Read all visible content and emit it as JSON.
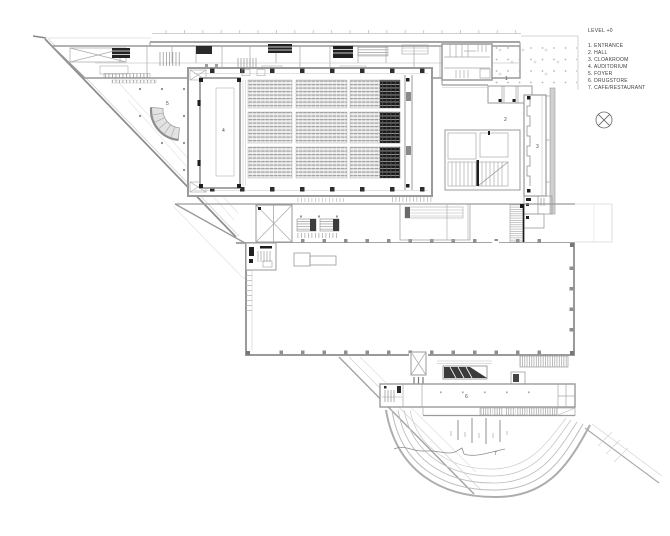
{
  "document": {
    "type": "architectural floor plan",
    "sheet_background": "#ffffff"
  },
  "legend": {
    "title": "LEVEL +0",
    "items": [
      "1. ENTRANCE",
      "2. HALL",
      "3. CLOAKROOM",
      "4. AUDITORIUM",
      "5. FOYER",
      "6. DRUGSTORE",
      "7. CAFE/RESTAURANT"
    ]
  },
  "plan_labels": [
    {
      "text": "1"
    },
    {
      "text": "2"
    },
    {
      "text": "3"
    },
    {
      "text": "4"
    },
    {
      "text": "5"
    },
    {
      "text": "6"
    },
    {
      "text": "7"
    }
  ],
  "icons": {
    "compass": "north-indicator-crossed-circle"
  },
  "colors": {
    "wall_gray": "#9a9a9a",
    "light_line": "#c4c4c4",
    "accent_black": "#1f1f1f",
    "seat_fill": "#ebebeb",
    "seat_dark": "#1a1a1a"
  }
}
